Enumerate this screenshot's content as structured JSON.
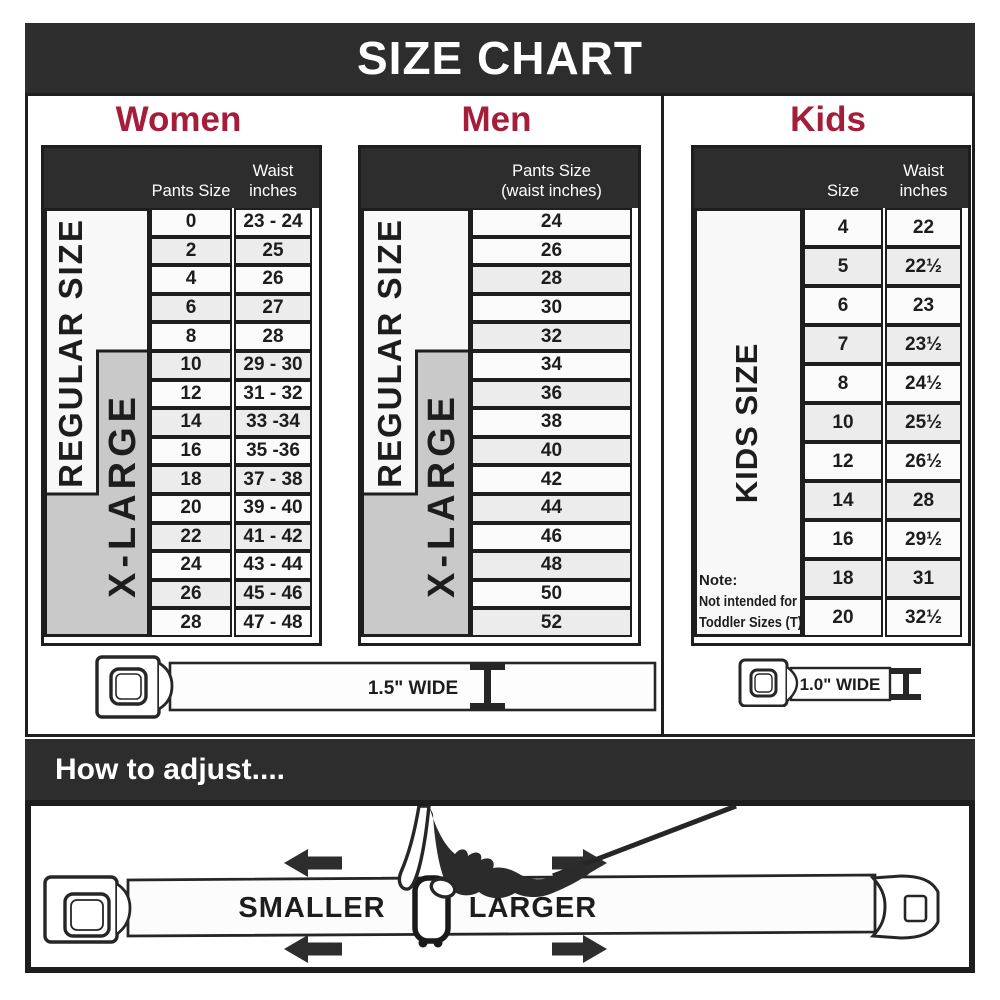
{
  "banner": {
    "title": "SIZE CHART"
  },
  "sections": {
    "women": {
      "title": "Women",
      "header": {
        "col1": "Pants Size",
        "col2": "Waist\ninches"
      },
      "labels": {
        "regular": "REGULAR SIZE",
        "xlarge": "X-LARGE"
      },
      "rows": [
        {
          "size": "0",
          "waist": "23 - 24"
        },
        {
          "size": "2",
          "waist": "25"
        },
        {
          "size": "4",
          "waist": "26"
        },
        {
          "size": "6",
          "waist": "27"
        },
        {
          "size": "8",
          "waist": "28"
        },
        {
          "size": "10",
          "waist": "29 - 30"
        },
        {
          "size": "12",
          "waist": "31 - 32"
        },
        {
          "size": "14",
          "waist": "33 -34"
        },
        {
          "size": "16",
          "waist": "35 -36"
        },
        {
          "size": "18",
          "waist": "37 - 38"
        },
        {
          "size": "20",
          "waist": "39 - 40"
        },
        {
          "size": "22",
          "waist": "41 - 42"
        },
        {
          "size": "24",
          "waist": "43 - 44"
        },
        {
          "size": "26",
          "waist": "45 - 46"
        },
        {
          "size": "28",
          "waist": "47 - 48"
        }
      ]
    },
    "men": {
      "title": "Men",
      "header": {
        "col1": "Pants Size\n(waist inches)"
      },
      "labels": {
        "regular": "REGULAR SIZE",
        "xlarge": "X-LARGE"
      },
      "rows": [
        {
          "size": "24"
        },
        {
          "size": "26"
        },
        {
          "size": "28"
        },
        {
          "size": "30"
        },
        {
          "size": "32"
        },
        {
          "size": "34"
        },
        {
          "size": "36"
        },
        {
          "size": "38"
        },
        {
          "size": "40"
        },
        {
          "size": "42"
        },
        {
          "size": "44"
        },
        {
          "size": "46"
        },
        {
          "size": "48"
        },
        {
          "size": "50"
        },
        {
          "size": "52"
        }
      ]
    },
    "kids": {
      "title": "Kids",
      "header": {
        "col1": "Size",
        "col2": "Waist\ninches"
      },
      "labels": {
        "kids": "KIDS SIZE"
      },
      "note": {
        "line1": "Note:",
        "line2": "Not intended for",
        "line3": "Toddler Sizes (T)"
      },
      "rows": [
        {
          "size": "4",
          "waist": "22"
        },
        {
          "size": "5",
          "waist": "22½"
        },
        {
          "size": "6",
          "waist": "23"
        },
        {
          "size": "7",
          "waist": "23½"
        },
        {
          "size": "8",
          "waist": "24½"
        },
        {
          "size": "10",
          "waist": "25½"
        },
        {
          "size": "12",
          "waist": "26½"
        },
        {
          "size": "14",
          "waist": "28"
        },
        {
          "size": "16",
          "waist": "29½"
        },
        {
          "size": "18",
          "waist": "31"
        },
        {
          "size": "20",
          "waist": "32½"
        }
      ]
    }
  },
  "belts": {
    "adult_width_label": "1.5\" WIDE",
    "kids_width_label": "1.0\" WIDE"
  },
  "how_to": {
    "title": "How to adjust....",
    "smaller": "SMALLER",
    "larger": "LARGER"
  },
  "colors": {
    "accent_red": "#a41e3c",
    "dark_charcoal": "#2d2d2d",
    "xlarge_gray": "#c9c9c9",
    "row_alt_gray": "#ececec"
  }
}
